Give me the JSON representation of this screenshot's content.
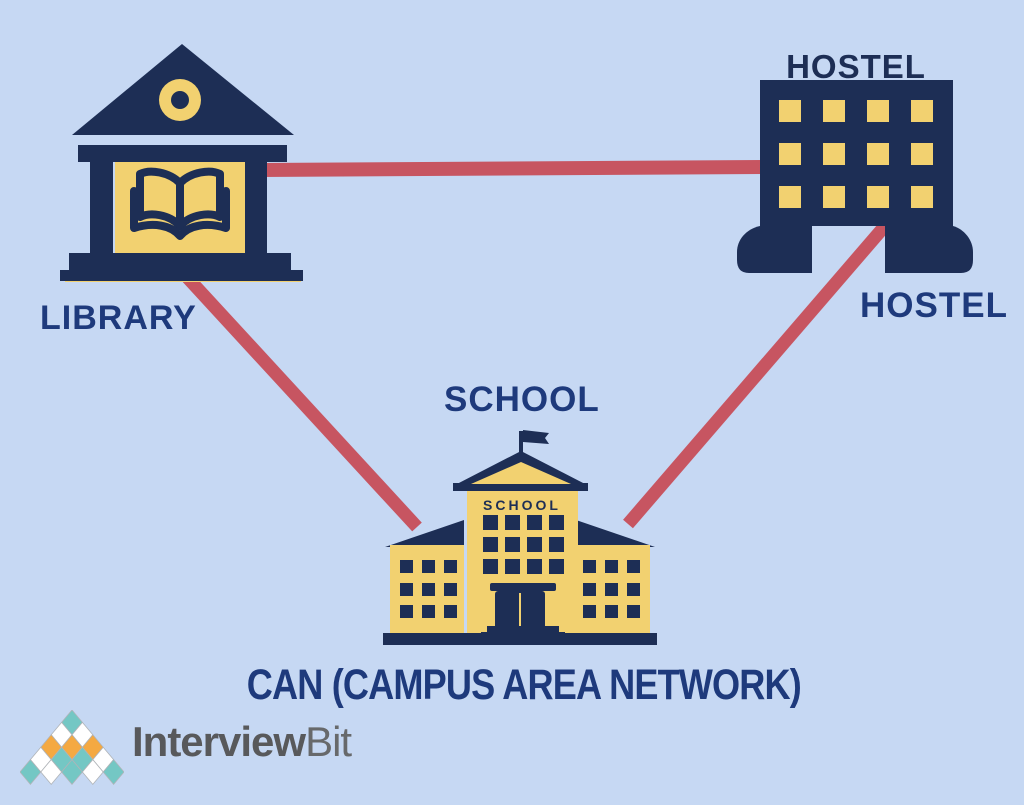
{
  "nodes": [
    {
      "id": "library",
      "label": "LIBRARY"
    },
    {
      "id": "hostel",
      "label": "HOSTEL",
      "building_sign": "HOSTEL"
    },
    {
      "id": "school",
      "label": "SCHOOL",
      "building_sign": "SCHOOL"
    }
  ],
  "links": [
    {
      "from": "library",
      "to": "hostel"
    },
    {
      "from": "library",
      "to": "school"
    },
    {
      "from": "hostel",
      "to": "school"
    }
  ],
  "caption": "CAN (CAMPUS AREA NETWORK)",
  "logo": {
    "brand_bold": "Interview",
    "brand_light": "Bit",
    "pyramid_rows": [
      [
        "teal"
      ],
      [
        "white",
        "white"
      ],
      [
        "orange",
        "orange",
        "orange"
      ],
      [
        "white",
        "teal",
        "teal",
        "white"
      ],
      [
        "teal",
        "white",
        "teal",
        "white",
        "teal"
      ]
    ]
  },
  "colors": {
    "background": "#c6d8f3",
    "building_navy": "#1d2e55",
    "label_navy": "#1e3a7c",
    "accent_yellow": "#f2d170",
    "link_red": "#c75561",
    "logo_teal": "#74c7c4",
    "logo_orange": "#f4a942",
    "logo_white": "#ffffff",
    "brand_gray": "#58595b"
  }
}
